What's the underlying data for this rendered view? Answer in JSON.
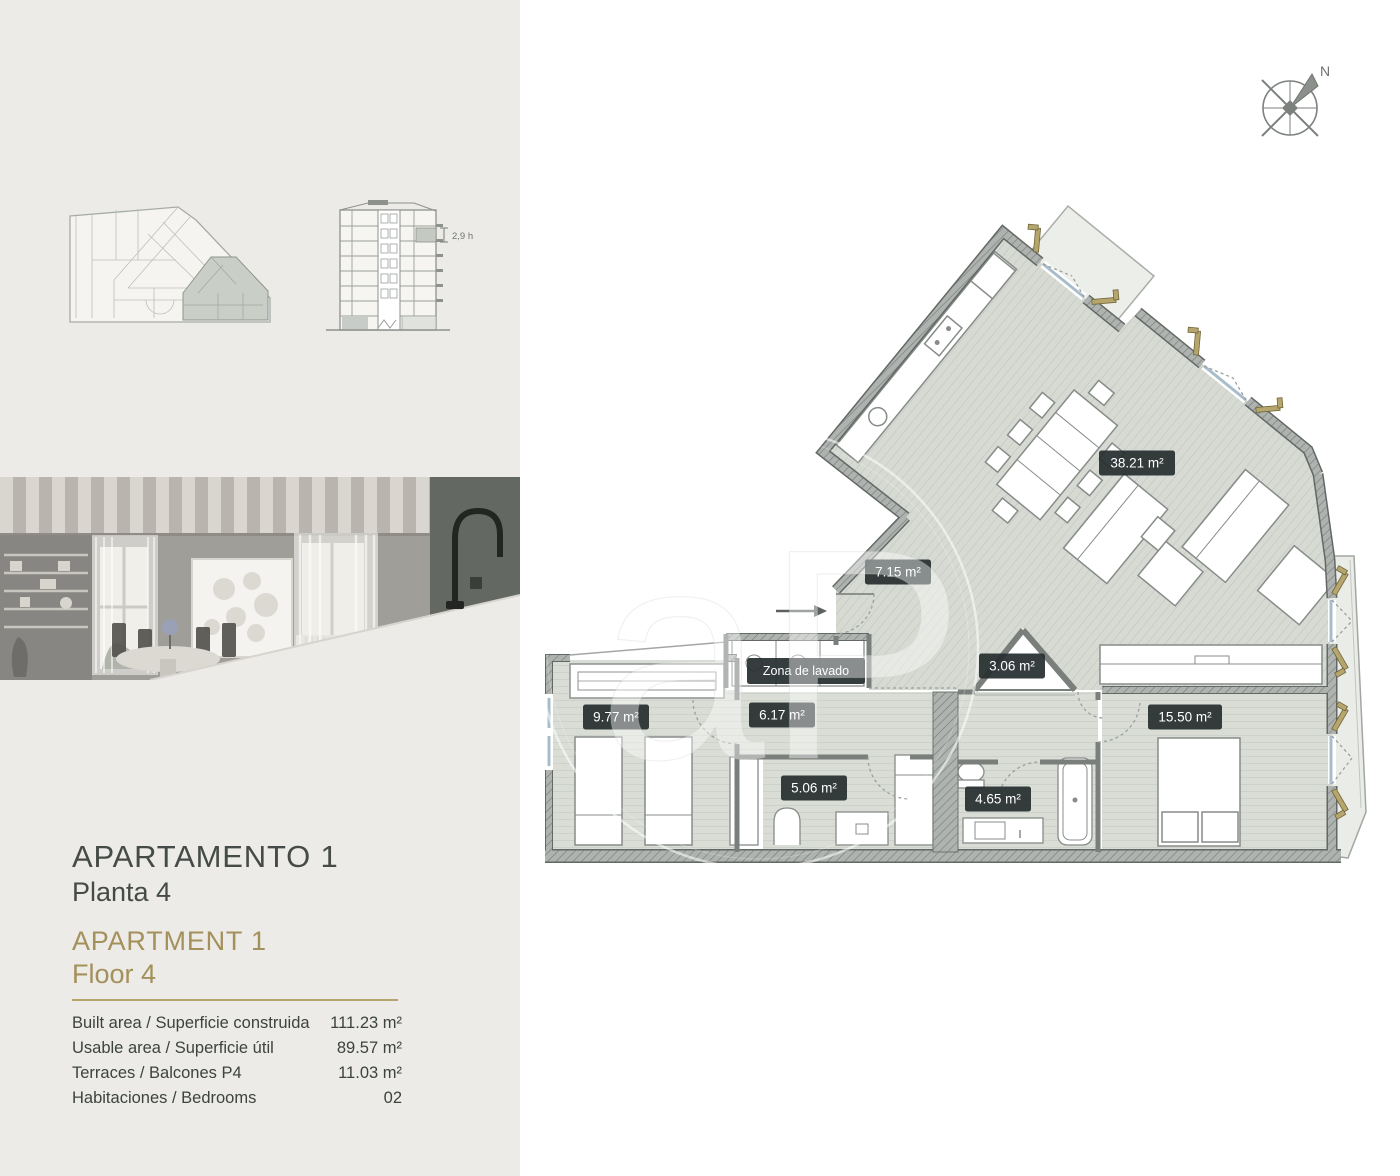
{
  "colors": {
    "panel_bg": "#ecebe7",
    "accent_gold": "#a3905a",
    "heading": "#454b48",
    "badge_bg": "#272e2f",
    "plan_floor": "#d9ddd6",
    "shutter_tan": "#b6a66e"
  },
  "compass": {
    "north_label": "N"
  },
  "building_section": {
    "height_label": "2,9 h"
  },
  "title_block": {
    "title_es": "APARTAMENTO 1",
    "subtitle_es": "Planta 4",
    "title_en": "APARTMENT 1",
    "subtitle_en": "Floor 4",
    "specs": [
      {
        "label": "Built area / Superficie construida",
        "value": "111.23 m²"
      },
      {
        "label": "Usable area / Superficie útil",
        "value": "89.57 m²"
      },
      {
        "label": "Terraces / Balcones P4",
        "value": "11.03 m²"
      },
      {
        "label": "Habitaciones / Bedrooms",
        "value": "02"
      }
    ]
  },
  "floor_plan": {
    "watermark": "aP",
    "rooms": [
      {
        "id": "living-dining-kitchen",
        "text": "38.21 m²"
      },
      {
        "id": "hallway",
        "text": "7.15 m²"
      },
      {
        "id": "laundry",
        "text": "Zona de lavado"
      },
      {
        "id": "dressing",
        "text": "3.06 m²"
      },
      {
        "id": "bedroom-2",
        "text": "9.77 m²"
      },
      {
        "id": "corridor",
        "text": "6.17 m²"
      },
      {
        "id": "bedroom-1",
        "text": "15.50 m²"
      },
      {
        "id": "bathroom-2",
        "text": "5.06 m²"
      },
      {
        "id": "bathroom-1",
        "text": "4.65 m²"
      }
    ]
  }
}
